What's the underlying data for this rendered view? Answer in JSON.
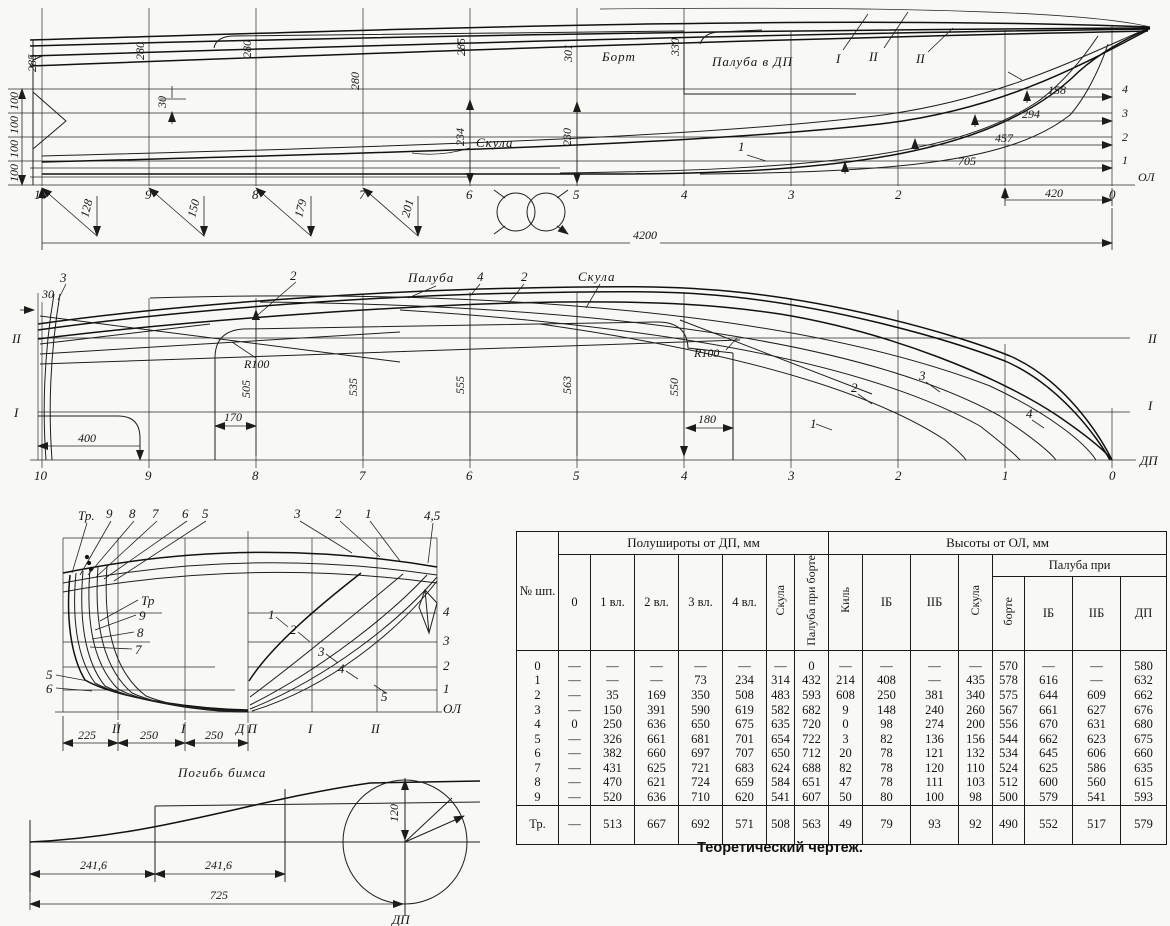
{
  "caption": "Теоретический чертеж.",
  "ink_color": "#1c1c1c",
  "paper_color": "#f8f8f4",
  "sheer_plan": {
    "stations": [
      "10",
      "9",
      "8",
      "7",
      "6",
      "5",
      "4",
      "3",
      "2",
      "1",
      "0"
    ],
    "baseline_label": "ОЛ",
    "waterline_labels": [
      "4",
      "3",
      "2",
      "1"
    ],
    "top_dims": [
      "285",
      "280",
      "280",
      "280",
      "285",
      "301",
      "330"
    ],
    "left_dims": [
      "100",
      "100",
      "100",
      "100"
    ],
    "right_dims": [
      "158",
      "294",
      "457",
      "705"
    ],
    "stern_dim": "420",
    "length_dim": "4200",
    "diag_dims": [
      "128",
      "150",
      "179",
      "201"
    ],
    "vert_dim_st6": "234",
    "vert_dim_st5": "230",
    "small_dim": "30",
    "label_bort": "Борт",
    "label_paluba_dp": "Палуба в ДП",
    "label_skula": "Скула",
    "label_wl1": "1",
    "label_butt_I": "I",
    "label_butt_II": "II",
    "label_butt_II2": "II"
  },
  "half_breadth": {
    "stations": [
      "10",
      "9",
      "8",
      "7",
      "6",
      "5",
      "4",
      "3",
      "2",
      "1",
      "0"
    ],
    "dp_label": "ДП",
    "left_butt_II": "II",
    "left_butt_I": "I",
    "right_butt_II": "II",
    "right_butt_I": "I",
    "label_paluba": "Палуба",
    "label_skula": "Скула",
    "label_4": "4",
    "label_2": "2",
    "label_curve2": "2",
    "label_curve3": "3",
    "radius_label_1": "R100",
    "radius_label_2": "R100",
    "dim_30": "30",
    "dim_400": "400",
    "dim_170": "170",
    "dim_180": "180",
    "station_dims": [
      "505",
      "535",
      "555",
      "563",
      "550"
    ],
    "curve_labels": [
      "1",
      "2",
      "3",
      "4"
    ]
  },
  "body_plan": {
    "top_labels_left": [
      "Тр.",
      "9",
      "8",
      "7",
      "6",
      "5"
    ],
    "top_labels_right": [
      "3",
      "2",
      "1",
      "4,5"
    ],
    "inner_labels_left": [
      "Тр",
      "9",
      "8",
      "7"
    ],
    "lower_labels_left": [
      "5",
      "6"
    ],
    "curve_labels_right": [
      "1",
      "2",
      "3",
      "4",
      "5"
    ],
    "waterline_labels": [
      "4",
      "3",
      "2",
      "1",
      "ОЛ"
    ],
    "bottom_labels": [
      "II",
      "I",
      "Д П",
      "I",
      "II"
    ],
    "bottom_dims": [
      "225",
      "250",
      "250"
    ]
  },
  "beam_camber": {
    "title": "Погибь бимса",
    "dim_1": "241,6",
    "dim_2": "241,6",
    "dim_3": "725",
    "radius_dim": "120",
    "dp_label": "ДП"
  },
  "offsets_table": {
    "col_station": "№ шп.",
    "group_halfwidths": "Полушироты от ДП, мм",
    "group_heights": "Высоты от ОЛ, мм",
    "subgroup_deck": "Палуба при",
    "halfwidth_cols": [
      "0",
      "1 вл.",
      "2 вл.",
      "3 вл.",
      "4 вл.",
      "Скула",
      "Палуба при борте"
    ],
    "height_cols": [
      "Киль",
      "IБ",
      "IIБ",
      "Скула"
    ],
    "deck_cols": [
      "борте",
      "IБ",
      "IIБ",
      "ДП"
    ],
    "rows": [
      {
        "station": "0",
        "cells": [
          "—",
          "—",
          "—",
          "—",
          "—",
          "—",
          "0",
          "—",
          "—",
          "—",
          "—",
          "570",
          "—",
          "—",
          "580"
        ]
      },
      {
        "station": "1",
        "cells": [
          "—",
          "—",
          "—",
          "73",
          "234",
          "314",
          "432",
          "214",
          "408",
          "—",
          "435",
          "578",
          "616",
          "—",
          "632"
        ]
      },
      {
        "station": "2",
        "cells": [
          "—",
          "35",
          "169",
          "350",
          "508",
          "483",
          "593",
          "608",
          "250",
          "381",
          "340",
          "575",
          "644",
          "609",
          "662"
        ]
      },
      {
        "station": "3",
        "cells": [
          "—",
          "150",
          "391",
          "590",
          "619",
          "582",
          "682",
          "9",
          "148",
          "240",
          "260",
          "567",
          "661",
          "627",
          "676"
        ]
      },
      {
        "station": "4",
        "cells": [
          "0",
          "250",
          "636",
          "650",
          "675",
          "635",
          "720",
          "0",
          "98",
          "274",
          "200",
          "556",
          "670",
          "631",
          "680"
        ]
      },
      {
        "station": "5",
        "cells": [
          "—",
          "326",
          "661",
          "681",
          "701",
          "654",
          "722",
          "3",
          "82",
          "136",
          "156",
          "544",
          "662",
          "623",
          "675"
        ]
      },
      {
        "station": "6",
        "cells": [
          "—",
          "382",
          "660",
          "697",
          "707",
          "650",
          "712",
          "20",
          "78",
          "121",
          "132",
          "534",
          "645",
          "606",
          "660"
        ]
      },
      {
        "station": "7",
        "cells": [
          "—",
          "431",
          "625",
          "721",
          "683",
          "624",
          "688",
          "82",
          "78",
          "120",
          "110",
          "524",
          "625",
          "586",
          "635"
        ]
      },
      {
        "station": "8",
        "cells": [
          "—",
          "470",
          "621",
          "724",
          "659",
          "584",
          "651",
          "47",
          "78",
          "111",
          "103",
          "512",
          "600",
          "560",
          "615"
        ]
      },
      {
        "station": "9",
        "cells": [
          "—",
          "520",
          "636",
          "710",
          "620",
          "541",
          "607",
          "50",
          "80",
          "100",
          "98",
          "500",
          "579",
          "541",
          "593"
        ]
      },
      {
        "station": "Тр.",
        "cells": [
          "—",
          "513",
          "667",
          "692",
          "571",
          "508",
          "563",
          "49",
          "79",
          "93",
          "92",
          "490",
          "552",
          "517",
          "579"
        ]
      }
    ]
  }
}
